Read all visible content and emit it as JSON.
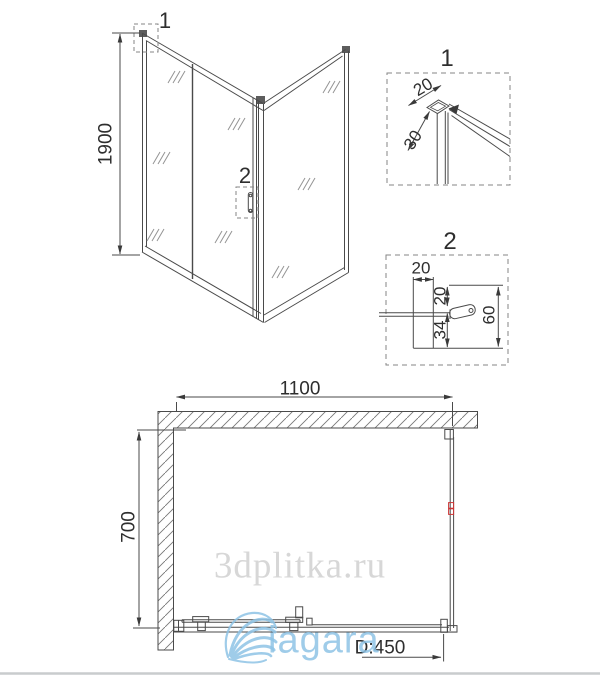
{
  "drawing": {
    "front_view": {
      "height_dim": "1900",
      "detail1_marker": "1",
      "detail2_marker": "2"
    },
    "detail_1": {
      "title": "1",
      "dim_profile_width": "20",
      "dim_profile_depth": "30"
    },
    "detail_2": {
      "title": "2",
      "dim_top_width": "20",
      "dim_upper_offset": "20",
      "dim_lower_offset": "34",
      "dim_total_height": "60"
    },
    "plan_view": {
      "width_dim": "1100",
      "depth_dim": "700",
      "door_dim": "D:450"
    },
    "watermark": "3dplitka.ru",
    "logo_text": "iagara",
    "colors": {
      "line": "#4a4a4a",
      "accent_red": "#cc3434",
      "logo_blue": "#8fc4e6",
      "watermark_gray": "#d7d7d7"
    }
  }
}
